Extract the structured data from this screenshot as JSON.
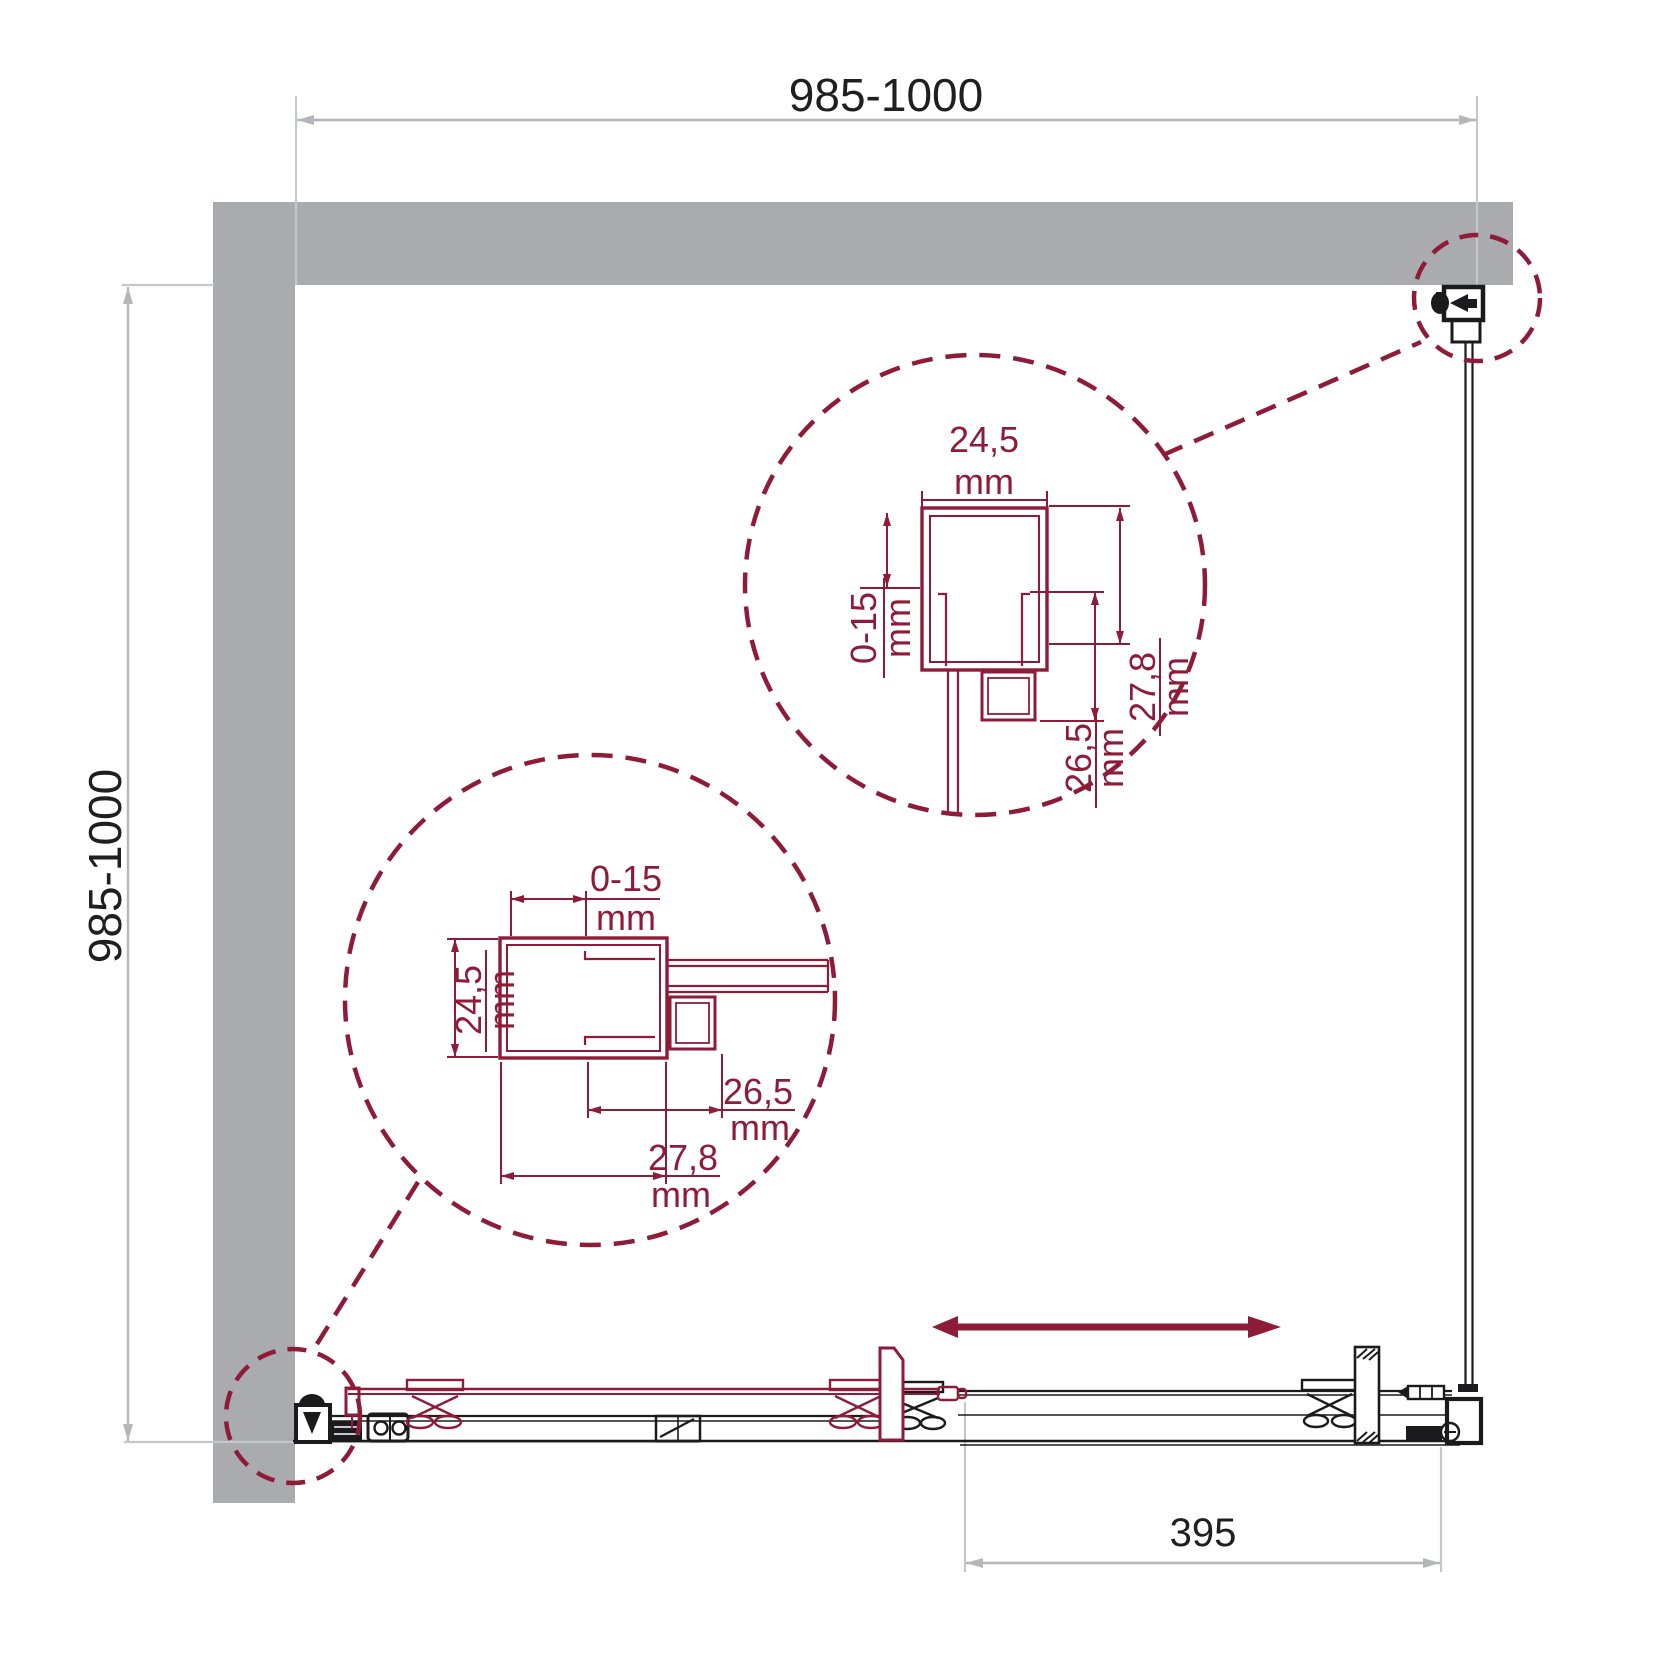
{
  "colors": {
    "accent": "#8E1C39",
    "wall_gray": "#A9ABAE",
    "dim_gray": "#B5B6BA",
    "ext_gray": "#C6C7CA",
    "line_black": "#1B1B1D"
  },
  "dimensions": {
    "top": {
      "label": "985-1000"
    },
    "left": {
      "label": "985-1000"
    },
    "opening": {
      "label": "395"
    }
  },
  "detail_upper": {
    "width": {
      "value": "24,5",
      "unit": "mm"
    },
    "adjustment": {
      "value": "0-15",
      "unit": "mm"
    },
    "depth": {
      "value": "27,8",
      "unit": "mm"
    },
    "inner_depth": {
      "value": "26,5",
      "unit": "mm"
    }
  },
  "detail_lower": {
    "adjustment": {
      "value": "0-15",
      "unit": "mm"
    },
    "width": {
      "value": "24,5",
      "unit": "mm"
    },
    "inner_depth": {
      "value": "26,5",
      "unit": "mm"
    },
    "depth": {
      "value": "27,8",
      "unit": "mm"
    }
  },
  "icons": {
    "slide_direction": "double-arrow"
  }
}
